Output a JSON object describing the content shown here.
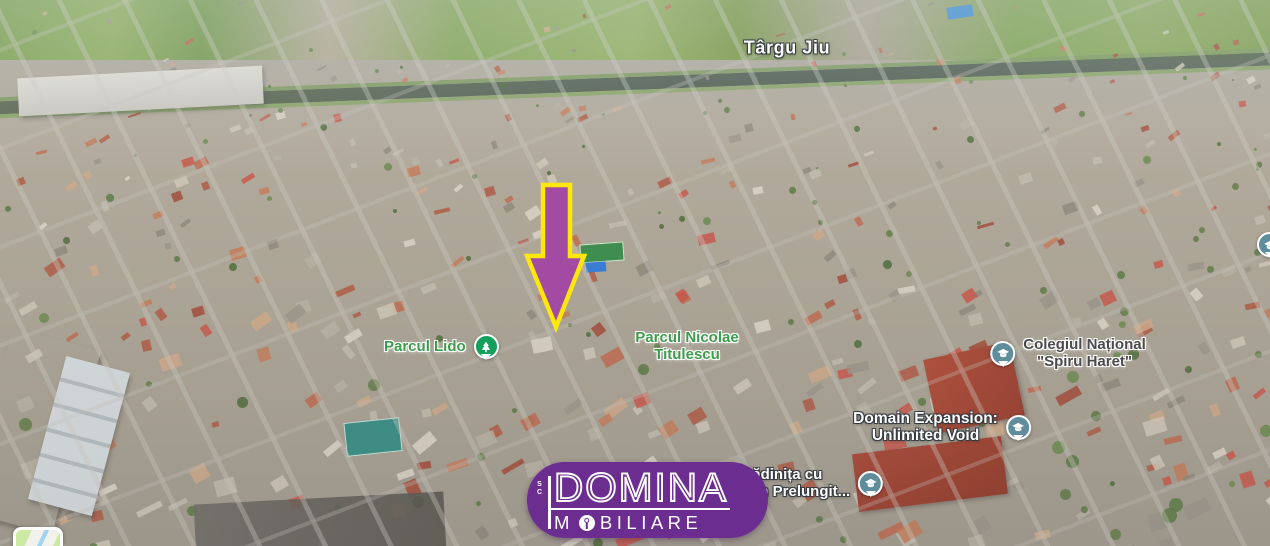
{
  "map": {
    "city_label": "Târgu Jiu",
    "labels": {
      "parcul_lido": {
        "text": "Parcul Lido",
        "icon": "park-tree-pin"
      },
      "parcul_titulescu": {
        "line1": "Parcul Nicolae",
        "line2": "Titulescu"
      },
      "colegiul": {
        "line1": "Colegiul Național",
        "line2": "\"Spiru Haret\"",
        "icon": "school-graduation-cap-pin"
      },
      "domain_expansion": {
        "line1": "Domain Expansion:",
        "line2": "Unlimited Void",
        "icon": "school-graduation-cap-pin"
      },
      "gradinita": {
        "line1": "Grădinița cu",
        "line2": "Program Prelungit...",
        "icon": "school-graduation-cap-pin"
      }
    },
    "colors": {
      "park_label_green": "#3d9b4c",
      "park_pin_green": "#12a05c",
      "school_pin_slate": "#5f8d9c",
      "city_label_white": "#ffffff",
      "school_label_gray": "#4b4b4d"
    }
  },
  "marker": {
    "shape": "down-arrow",
    "fill": "#a34ba3",
    "outline": "#ffe70b"
  },
  "logo": {
    "prefix": "SC",
    "name": "DOMINA",
    "subtitle_full": "IMOBILIARE",
    "subtitle_before_o": "M",
    "subtitle_after_o": "BILIARE",
    "background": "#6b2d90",
    "text_color": "#ffffff"
  }
}
